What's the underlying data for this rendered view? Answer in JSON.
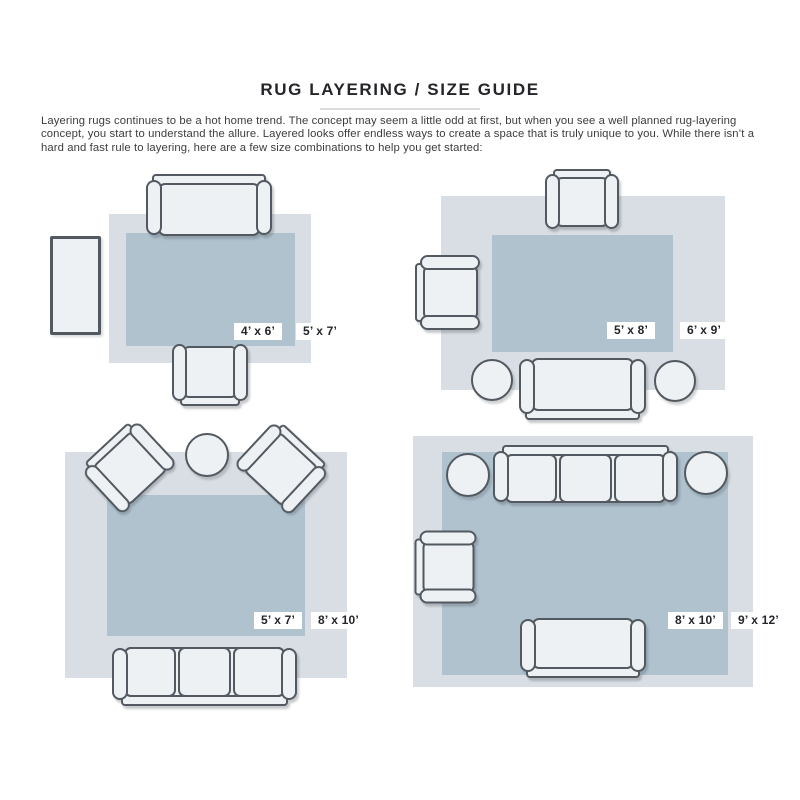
{
  "page": {
    "title": "RUG LAYERING / SIZE GUIDE",
    "intro": "Layering rugs continues to be a hot home trend. The concept may seem a little odd at first, but when you see a well planned rug-layering concept, you start to understand the allure. Layered looks offer endless ways to create a space that is truly unique to you. While there isn’t a hard and fast rule to layering, here are a few size combinations to help you get started:"
  },
  "colors": {
    "rug_base": "#d9dee4",
    "rug_top": "#afc2ce",
    "furniture_fill": "#eef1f4",
    "furniture_outline": "#525960",
    "label_text": "#23252a"
  },
  "layouts": [
    {
      "name": "loveseat-with-armchair",
      "top_rug_label": "4’ x 6’",
      "base_rug_label": "5’ x 7’",
      "furniture": [
        "loveseat",
        "console-table",
        "armchair"
      ]
    },
    {
      "name": "two-armchairs-with-sofa",
      "top_rug_label": "5’ x 8’",
      "base_rug_label": "6’ x 9’",
      "furniture": [
        "armchair",
        "armchair",
        "sofa",
        "round-side-table",
        "round-side-table"
      ]
    },
    {
      "name": "angled-armchairs-with-sofa",
      "top_rug_label": "5’ x 7’",
      "base_rug_label": "8’ x 10’",
      "furniture": [
        "armchair",
        "round-side-table",
        "armchair",
        "three-seat-sofa"
      ]
    },
    {
      "name": "full-living-room",
      "top_rug_label": "8’ x 10’",
      "base_rug_label": "9’ x 12’",
      "furniture": [
        "three-seat-sofa",
        "round-side-table",
        "round-side-table",
        "armchair",
        "loveseat"
      ]
    }
  ]
}
